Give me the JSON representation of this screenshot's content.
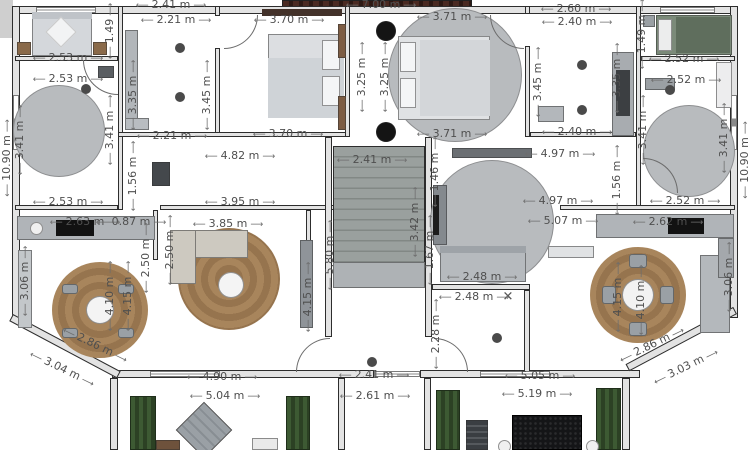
{
  "plan": {
    "unit": "m",
    "colors": {
      "wall_fill": "#e3e3e3",
      "wall_line": "#2d2d2d",
      "dimension_text": "#4f4f4f",
      "wood_rug": "#a8855c",
      "grey_rug": "#b8bbbe",
      "hedge_green": "#3d5a33",
      "green_bed": "#66755f",
      "stairs_grey": "#9aa09e"
    },
    "cross_marker": {
      "glyph": "✕"
    },
    "labels": [
      {
        "t": "2.41 m",
        "x": 171,
        "y": 5
      },
      {
        "t": "7.00 m",
        "x": 381,
        "y": 5
      },
      {
        "t": "2.60 m",
        "x": 576,
        "y": 9
      },
      {
        "t": "2.21 m",
        "x": 176,
        "y": 20
      },
      {
        "t": "3.70 m",
        "x": 289,
        "y": 20
      },
      {
        "t": "3.71 m",
        "x": 452,
        "y": 17
      },
      {
        "t": "2.40 m",
        "x": 577,
        "y": 22
      },
      {
        "t": "1.49",
        "x": 110,
        "y": 31,
        "r": -90
      },
      {
        "t": "1.49 m",
        "x": 642,
        "y": 34,
        "r": -90
      },
      {
        "t": "2.53 m",
        "x": 68,
        "y": 58
      },
      {
        "t": "2.52 m",
        "x": 684,
        "y": 59
      },
      {
        "t": "2.53 m",
        "x": 68,
        "y": 79
      },
      {
        "t": "2.52 m",
        "x": 686,
        "y": 80
      },
      {
        "t": "3.35 m",
        "x": 133,
        "y": 95,
        "r": -90
      },
      {
        "t": "3.45 m",
        "x": 207,
        "y": 95,
        "r": -90
      },
      {
        "t": "3.25 m",
        "x": 362,
        "y": 77,
        "r": -90
      },
      {
        "t": "3.25 m",
        "x": 385,
        "y": 77,
        "r": -90
      },
      {
        "t": "3.45 m",
        "x": 538,
        "y": 82,
        "r": -90
      },
      {
        "t": "3.35 m",
        "x": 617,
        "y": 78,
        "r": -90
      },
      {
        "t": "3.41 m",
        "x": 20,
        "y": 140,
        "r": -90
      },
      {
        "t": "3.41 m",
        "x": 110,
        "y": 130,
        "r": -90
      },
      {
        "t": "3.41 m",
        "x": 643,
        "y": 130,
        "r": -90
      },
      {
        "t": "3.41 m",
        "x": 724,
        "y": 138,
        "r": -90
      },
      {
        "t": "10.90 m",
        "x": 7,
        "y": 158,
        "r": -90
      },
      {
        "t": "10.90 m",
        "x": 745,
        "y": 160,
        "r": -90
      },
      {
        "t": "3.70 m",
        "x": 288,
        "y": 134
      },
      {
        "t": "3.71 m",
        "x": 452,
        "y": 134
      },
      {
        "t": "2.21 m",
        "x": 172,
        "y": 136
      },
      {
        "t": "2.40 m",
        "x": 577,
        "y": 132
      },
      {
        "t": "4.82 m",
        "x": 240,
        "y": 156
      },
      {
        "t": "4.97 m",
        "x": 560,
        "y": 154
      },
      {
        "t": "2.41 m",
        "x": 372,
        "y": 160
      },
      {
        "t": "1.56 m",
        "x": 133,
        "y": 176,
        "r": -90
      },
      {
        "t": "1.56 m",
        "x": 617,
        "y": 180,
        "r": -90
      },
      {
        "t": "1.46 m",
        "x": 435,
        "y": 172,
        "r": -90
      },
      {
        "t": "3.95 m",
        "x": 240,
        "y": 202
      },
      {
        "t": "4.97 m",
        "x": 558,
        "y": 201
      },
      {
        "t": "2.53 m",
        "x": 68,
        "y": 202
      },
      {
        "t": "2.52 m",
        "x": 685,
        "y": 201
      },
      {
        "t": "5.07 m",
        "x": 563,
        "y": 221
      },
      {
        "t": "2.63 m",
        "x": 85,
        "y": 222
      },
      {
        "t": "0.87 m",
        "x": 131,
        "y": 222
      },
      {
        "t": "3.85 m",
        "x": 228,
        "y": 224
      },
      {
        "t": "2.62 m",
        "x": 668,
        "y": 222
      },
      {
        "t": "3.42 m",
        "x": 415,
        "y": 222,
        "r": -90
      },
      {
        "t": "5.80 m",
        "x": 330,
        "y": 255,
        "r": -90
      },
      {
        "t": "1.67 m",
        "x": 430,
        "y": 250,
        "r": -90
      },
      {
        "t": "2.50 m",
        "x": 146,
        "y": 258,
        "r": -90
      },
      {
        "t": "2.50 m",
        "x": 170,
        "y": 250,
        "r": -90
      },
      {
        "t": "2.48 m",
        "x": 482,
        "y": 277
      },
      {
        "t": "2.48 m",
        "x": 474,
        "y": 297
      },
      {
        "t": "4.10 m",
        "x": 110,
        "y": 296,
        "r": -90
      },
      {
        "t": "4.15 m",
        "x": 128,
        "y": 296,
        "r": -90
      },
      {
        "t": "4.15 m",
        "x": 308,
        "y": 297,
        "r": -90
      },
      {
        "t": "4.15 m",
        "x": 618,
        "y": 297,
        "r": -90
      },
      {
        "t": "4.10 m",
        "x": 641,
        "y": 300,
        "r": -90
      },
      {
        "t": "3.06 m",
        "x": 25,
        "y": 281,
        "r": -90
      },
      {
        "t": "3.06 m",
        "x": 729,
        "y": 277,
        "r": -90
      },
      {
        "t": "2.28 m",
        "x": 436,
        "y": 334,
        "r": -90
      },
      {
        "t": "2.86 m",
        "x": 95,
        "y": 345,
        "r": 26
      },
      {
        "t": "3.04 m",
        "x": 62,
        "y": 369,
        "r": 26
      },
      {
        "t": "2.86 m",
        "x": 652,
        "y": 345,
        "r": -26
      },
      {
        "t": "3.03 m",
        "x": 686,
        "y": 367,
        "r": -26
      },
      {
        "t": "2.41 m",
        "x": 374,
        "y": 375
      },
      {
        "t": "4.90 m",
        "x": 222,
        "y": 377
      },
      {
        "t": "5.05 m",
        "x": 540,
        "y": 376
      },
      {
        "t": "2.61 m",
        "x": 375,
        "y": 396
      },
      {
        "t": "5.04 m",
        "x": 225,
        "y": 396
      },
      {
        "t": "5.19 m",
        "x": 537,
        "y": 394
      }
    ],
    "ceiling_lights": [
      [
        180,
        48
      ],
      [
        180,
        97
      ],
      [
        86,
        89
      ],
      [
        582,
        65
      ],
      [
        582,
        110
      ],
      [
        670,
        90
      ],
      [
        372,
        362
      ],
      [
        497,
        338
      ]
    ]
  }
}
